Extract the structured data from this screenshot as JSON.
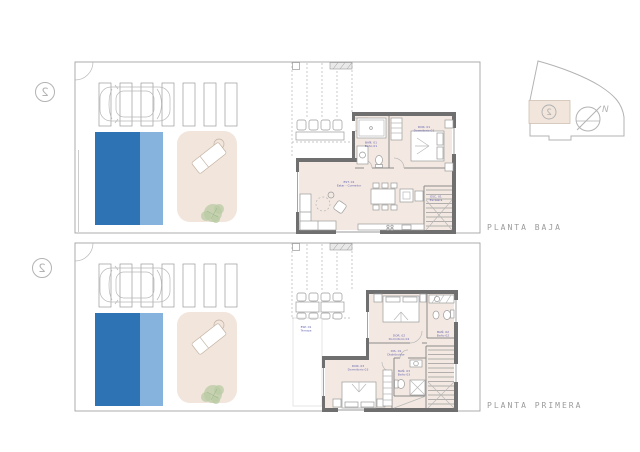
{
  "page": {
    "background": "#ffffff",
    "drawing_type": "two-storey villa floor plans"
  },
  "titles": {
    "ground": "PLANTA BAJA",
    "first": "PLANTA PRIMERA"
  },
  "unit_marker": "2",
  "site_key": {
    "north": "N",
    "unit": "2"
  },
  "ground_floor": {
    "rooms": {
      "bath1": {
        "code": "BAÑ. 01",
        "name": "Baño 01"
      },
      "bed1": {
        "code": "DOR. 01",
        "name": "Dormitorio 01"
      },
      "living": {
        "code": "EST. 01",
        "name": "Estar - Comedor"
      },
      "stairs": {
        "code": "ESC. 01",
        "name": "Escalera"
      }
    }
  },
  "first_floor": {
    "rooms": {
      "terrace": {
        "code": "ESP. 01",
        "name": "Terraza"
      },
      "bed2": {
        "code": "DOR. 02",
        "name": "Dormitorio 02"
      },
      "bath2": {
        "code": "BAÑ. 02",
        "name": "Baño 02"
      },
      "hall": {
        "code": "DIS. 01",
        "name": "Distribuidor"
      },
      "bath3": {
        "code": "BAÑ. 03",
        "name": "Baño 03"
      },
      "bed3": {
        "code": "DOR. 03",
        "name": "Dormitorio 03"
      }
    }
  },
  "colors": {
    "pool_dark": "#2e74b5",
    "pool_light": "#85b3de",
    "patio_beige": "#f1e5dc",
    "floor_beige": "#f4e9e2",
    "wall_gray": "#6f6f6f",
    "label_blue": "#6565b2",
    "line_gray": "#9b9b9b",
    "tree_green": "#b9cba4"
  }
}
